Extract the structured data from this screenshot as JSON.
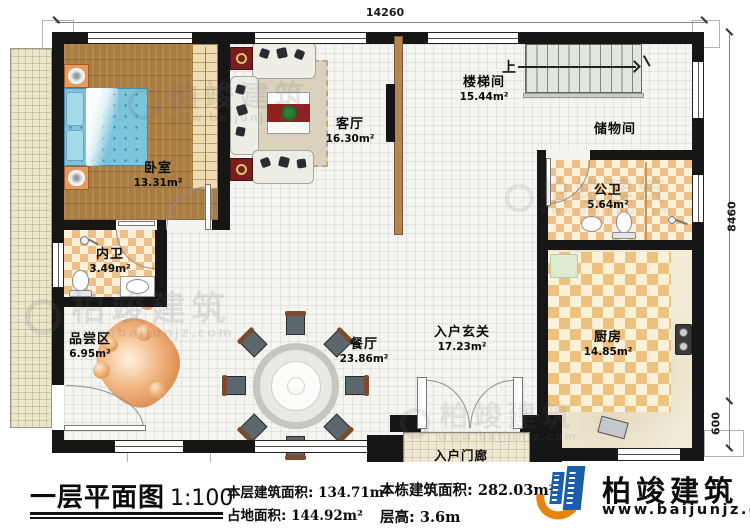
{
  "plan": {
    "rooms": {
      "bedroom": {
        "name": "卧室",
        "area": "13.31m²"
      },
      "living": {
        "name": "客厅",
        "area": "16.30m²"
      },
      "stairwell": {
        "name": "楼梯间",
        "area": "15.44m²"
      },
      "storage": {
        "name": "储物间"
      },
      "public_bath": {
        "name": "公卫",
        "area": "5.64m²"
      },
      "private_bath": {
        "name": "内卫",
        "area": "3.49m²"
      },
      "tasting": {
        "name": "品尝区",
        "area": "6.95m²"
      },
      "dining": {
        "name": "餐厅",
        "area": "23.86m²"
      },
      "foyer": {
        "name": "入户玄关",
        "area": "17.23m²"
      },
      "kitchen": {
        "name": "厨房",
        "area": "14.85m²"
      },
      "porch": {
        "name": "入户门廊"
      }
    },
    "stairs": {
      "direction_label": "上"
    },
    "dimensions": {
      "top_width": "14260",
      "right_height": "8460",
      "right_porch": "600"
    }
  },
  "title_block": {
    "title": "一层平面图",
    "scale": "1:100",
    "stats": [
      {
        "label": "本层建筑面积:",
        "value": "134.71m²"
      },
      {
        "label": "占地面积:",
        "value": "144.92m²"
      },
      {
        "label": "本栋建筑面积:",
        "value": "282.03m²"
      },
      {
        "label": "层高:",
        "value": "3.6m"
      }
    ],
    "brand": {
      "name": "柏竣建筑",
      "website": "www.baijunjz.com"
    }
  },
  "watermark": {
    "text": "柏竣建筑",
    "site": "www.baijunjz.com"
  },
  "colors": {
    "wall": "#161616",
    "brand_blue": "#1b5ea9",
    "brand_orange": "#e8830d",
    "wood_floor": "#a97c42",
    "tile_check": "#eec088",
    "bed_blue": "#7cc4da"
  }
}
